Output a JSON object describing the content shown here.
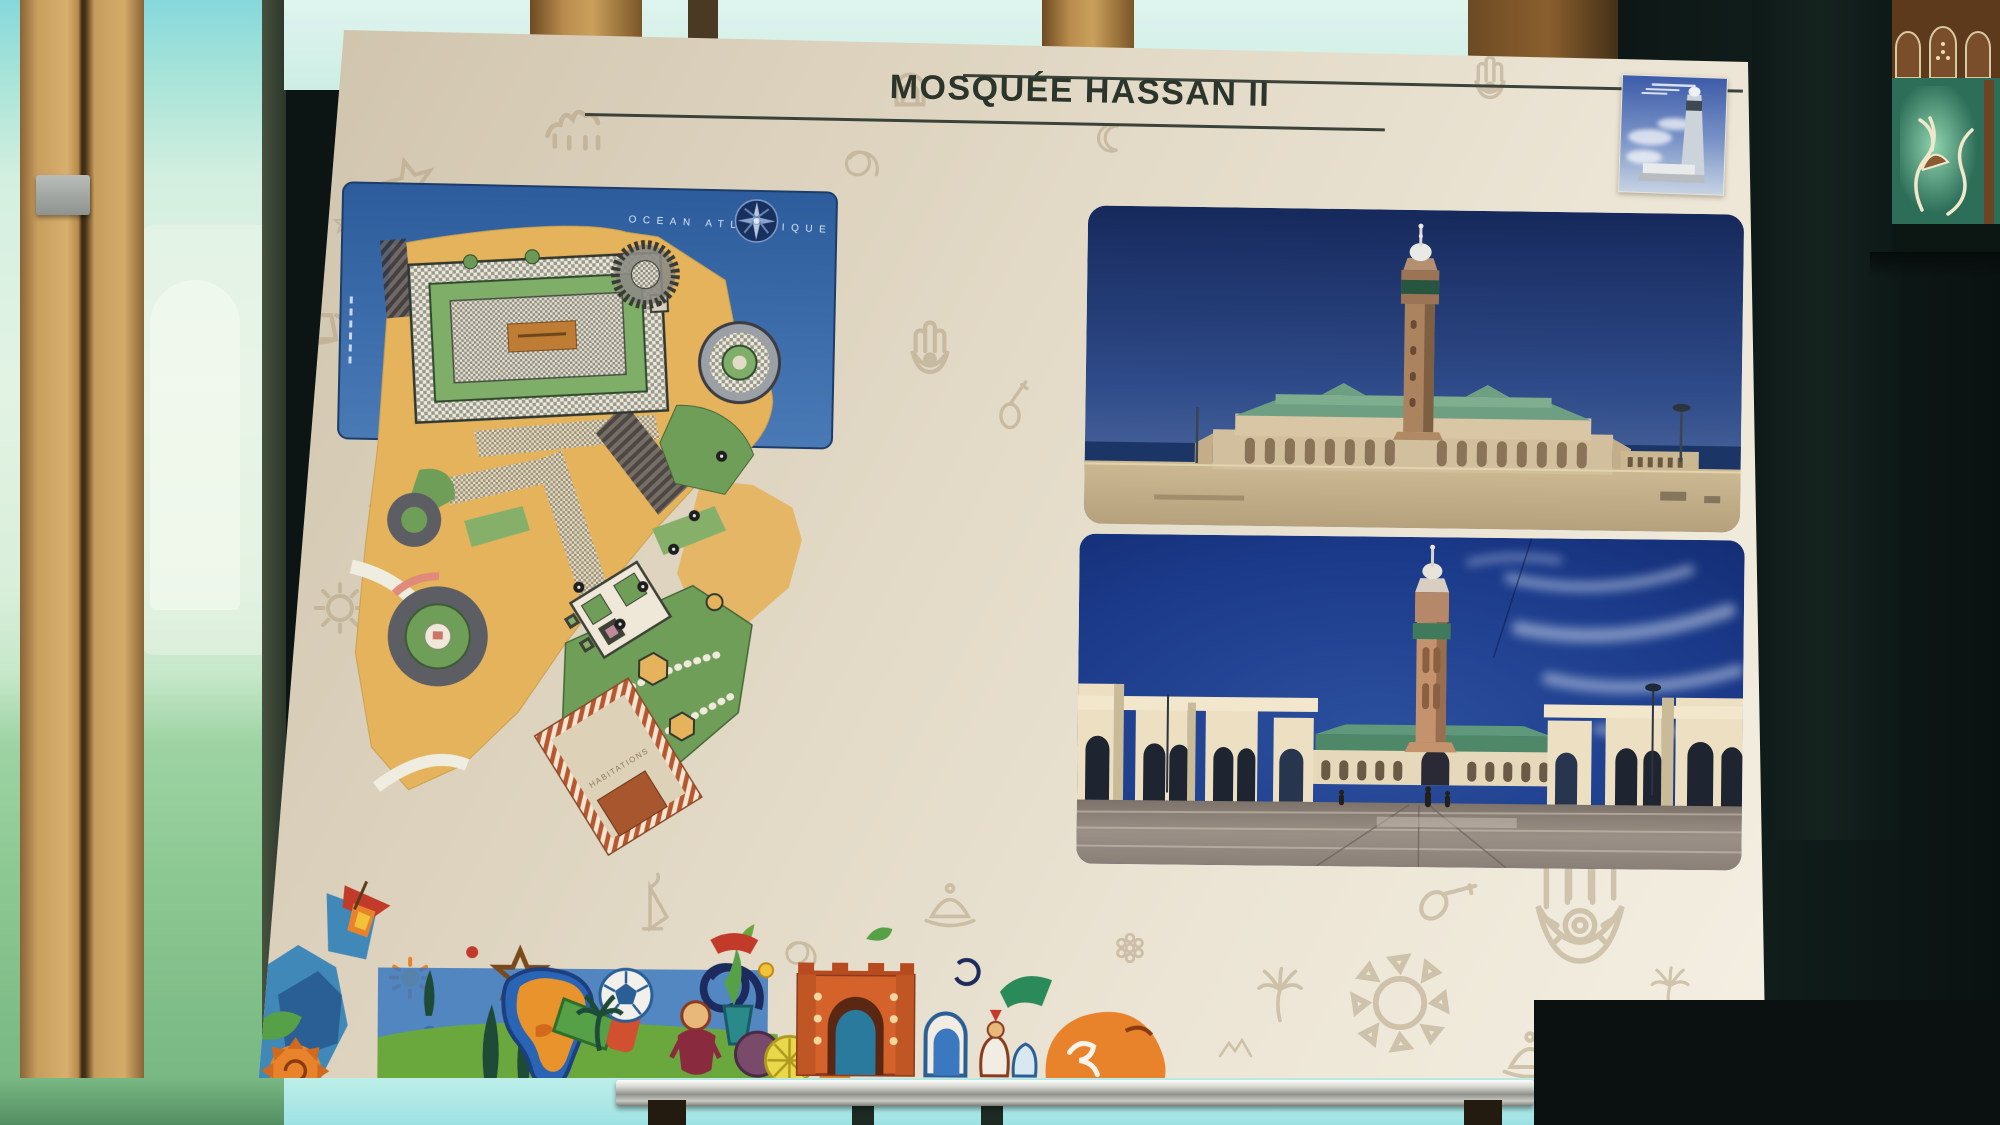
{
  "poster": {
    "title": "MOSQUÉE HASSAN II"
  },
  "plan": {
    "ocean_label": "OCEAN ATLANTIQUE",
    "habitations_label": "HABITATIONS"
  },
  "photos": {
    "top": "mosque-exterior-atlantic-view",
    "bottom": "mosque-esplanade-courtyard-view",
    "thumbnail": "mosque-minaret-poster-thumbnail"
  },
  "colors": {
    "poster_bg": "#e6ddca",
    "title": "#2b352b",
    "ocean_blue": "#3a69a7",
    "plaza_yellow": "#e4b35c",
    "garden_green": "#6f9e58",
    "photo_sky_blue": "#1c3a80",
    "arcade_cream": "#ecdfc2",
    "glass_green": "#bfe8d4",
    "wood_tan": "#c49a5e",
    "wall_dark": "#0c1414",
    "strip_orange": "#e8832c",
    "strip_teal": "#3f88b8",
    "doodle_tan": "#b4a283"
  }
}
